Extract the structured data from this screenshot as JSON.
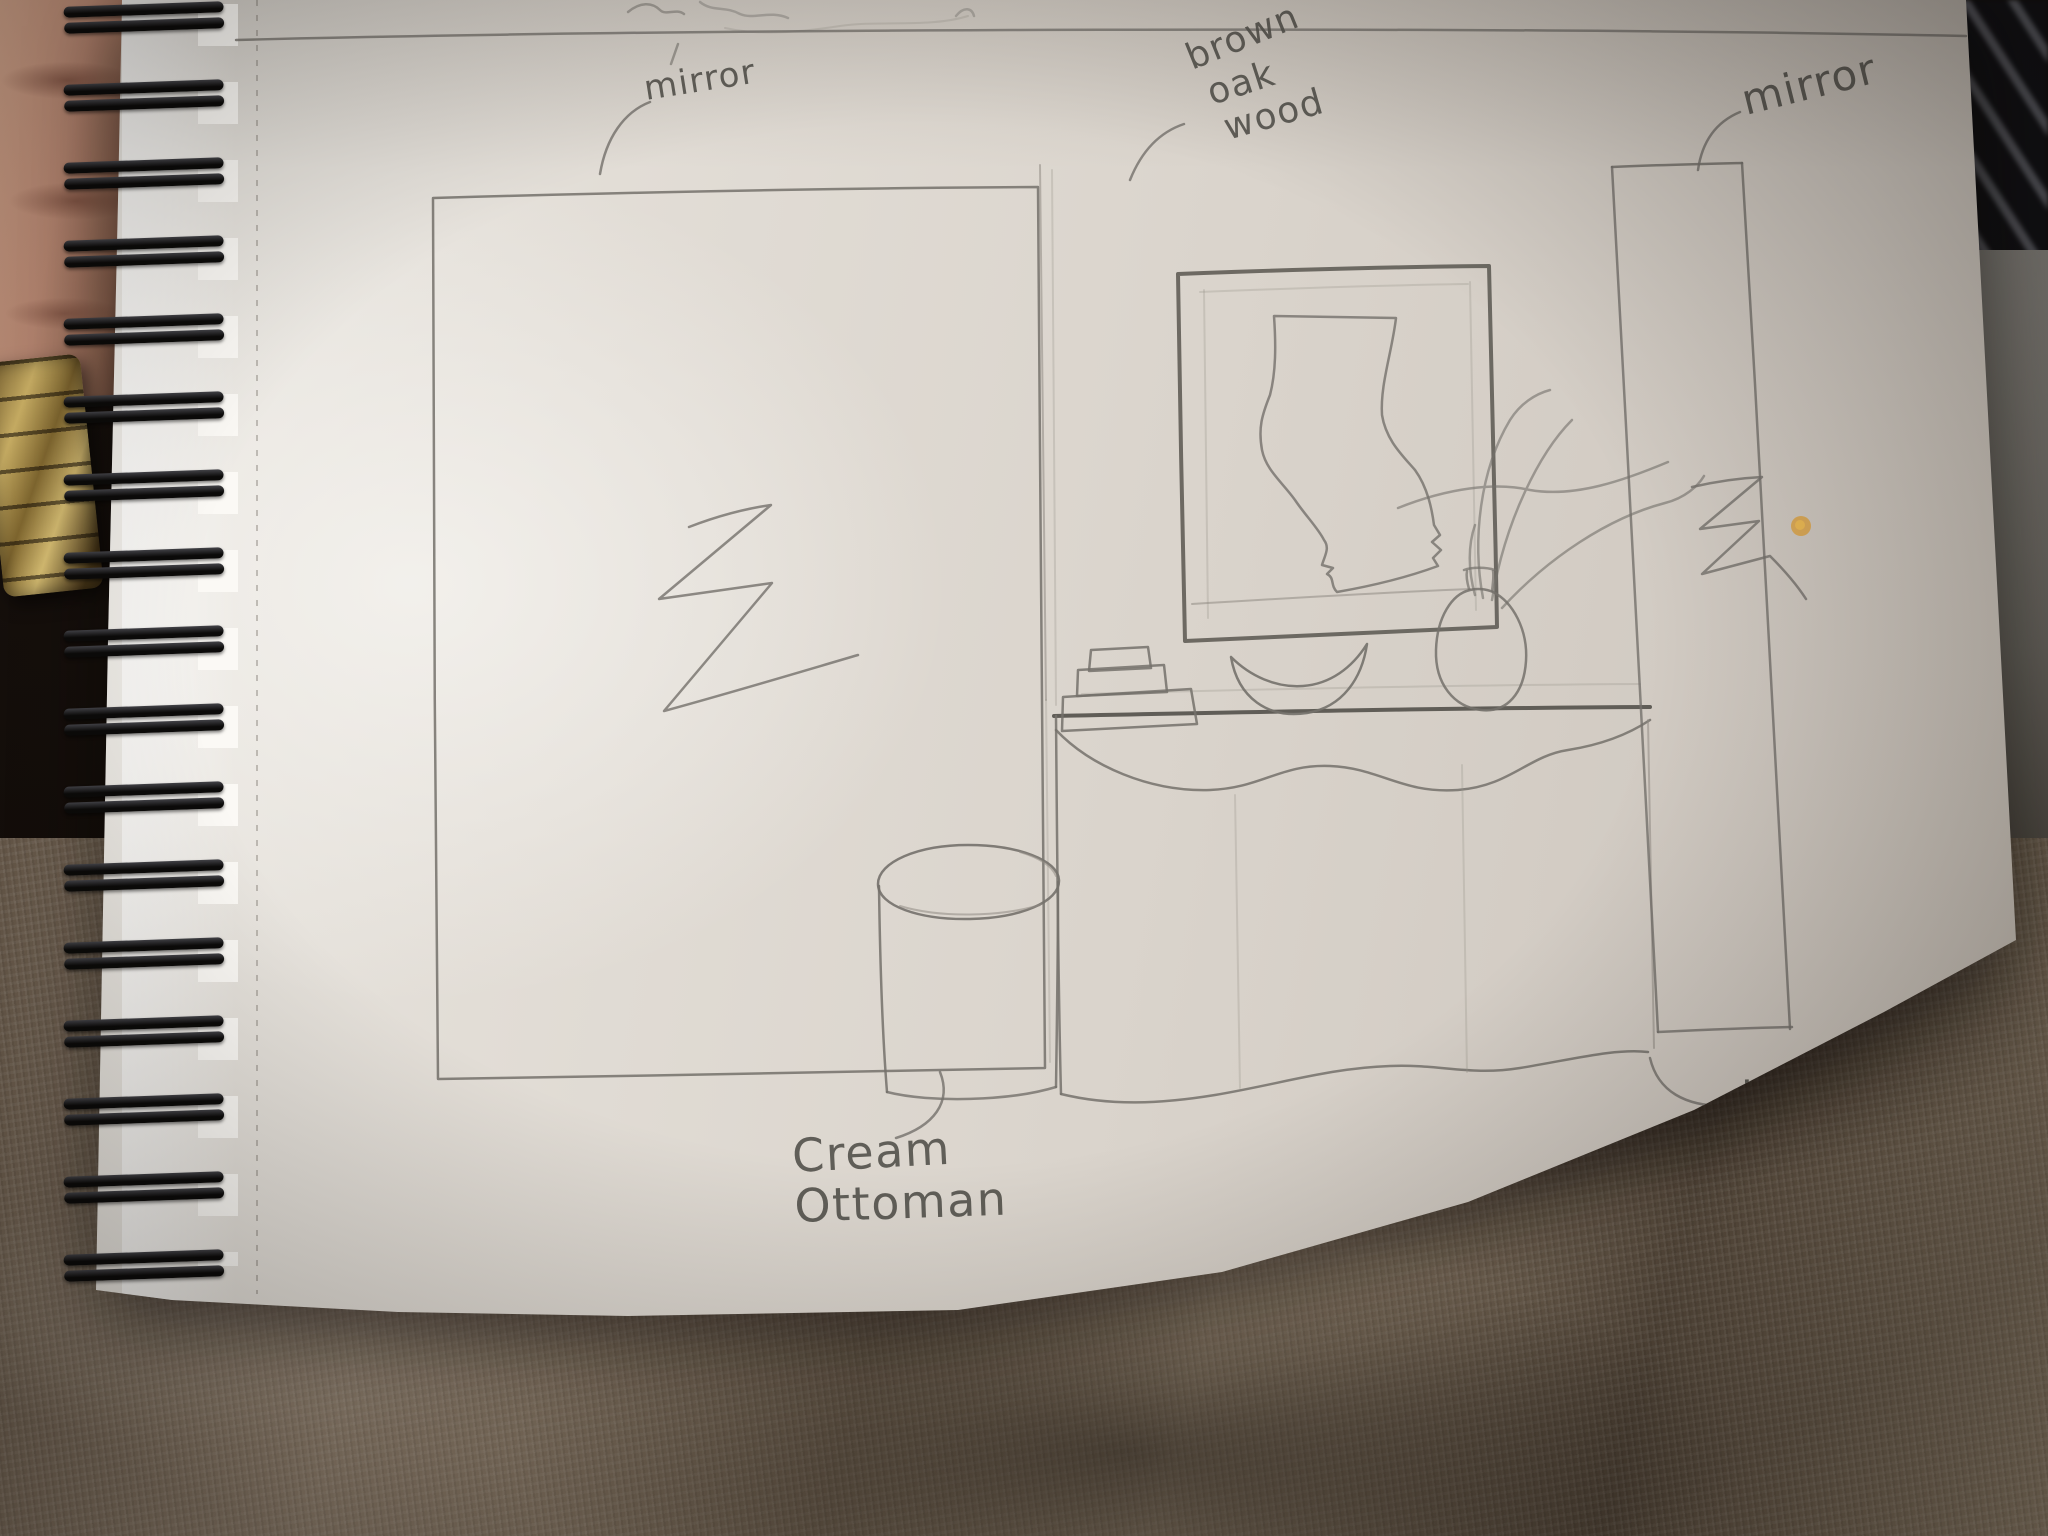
{
  "scene": {
    "kind": "photo of a pencil interior-design sketch on a spiral-bound sketchbook page",
    "objects_drawn": [
      "left wall mirror (large rectangle with shine squiggle)",
      "brown oak wood wall panel",
      "framed abstract artwork above console",
      "round vase with branches",
      "crescent-shaped bowl",
      "stack of three books",
      "console table with wavy apron and wavy base",
      "cream ottoman (cylinder)",
      "right wall mirror (tall rectangle with shine squiggle)"
    ],
    "top_edge_writing_legible": false
  },
  "annotations": {
    "mirror_left": {
      "text": "mirror"
    },
    "wood_panel": {
      "line1": "brown",
      "line2": "oak",
      "line3": "wood"
    },
    "mirror_right": {
      "text": "mirror"
    },
    "ottoman": {
      "line1": "Cream",
      "line2": "Ottoman"
    },
    "console": {
      "line1": "dark brown",
      "line2": "wooden",
      "line3": "console"
    }
  },
  "colors": {
    "paper": "#dcd6cf",
    "pencil": "#6e6b66",
    "blanket_taupe": "#8c7c6d",
    "skin": "#c5917a",
    "watch_gold": "#d9bc6b",
    "coil_black": "#161311",
    "stain_orange": "#dfa23d",
    "keyboard_black": "#131316"
  }
}
